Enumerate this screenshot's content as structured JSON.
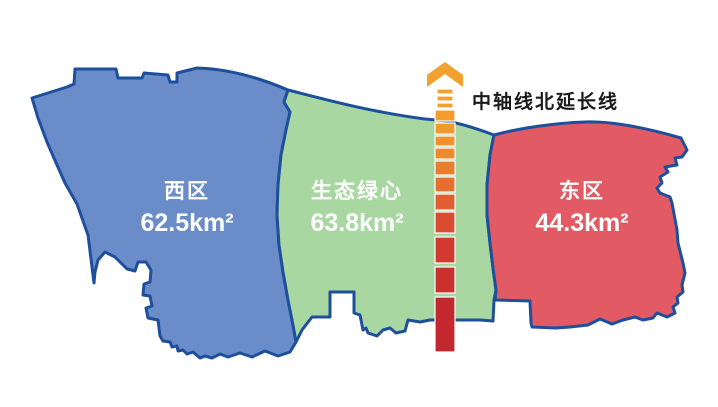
{
  "map": {
    "border_color": "#1D4F9C",
    "regions": [
      {
        "id": "west",
        "name": "西区",
        "area": "62.5km²",
        "fill": "#6A8CC8"
      },
      {
        "id": "green-heart",
        "name": "生态绿心",
        "area": "63.8km²",
        "fill": "#A8D7A2"
      },
      {
        "id": "east",
        "name": "东区",
        "area": "44.3km²",
        "fill": "#E25A63"
      }
    ]
  },
  "axis": {
    "label": "中轴线北延长线",
    "label_color": "#1A1A1A",
    "arrow_color": "#F2A12F",
    "dash_halo": "#FFFFFF",
    "dashes": [
      {
        "x": 437,
        "y": 89,
        "w": 16,
        "h": 5,
        "color": "#F5A12D"
      },
      {
        "x": 437,
        "y": 96,
        "w": 16,
        "h": 5,
        "color": "#F5A12D"
      },
      {
        "x": 437,
        "y": 103,
        "w": 16,
        "h": 5,
        "color": "#F4A02D"
      },
      {
        "x": 435,
        "y": 110,
        "w": 20,
        "h": 11,
        "color": "#F49C2D"
      },
      {
        "x": 435,
        "y": 123,
        "w": 20,
        "h": 11,
        "color": "#F2982E"
      },
      {
        "x": 435,
        "y": 136,
        "w": 20,
        "h": 10,
        "color": "#F0912E"
      },
      {
        "x": 435,
        "y": 148,
        "w": 20,
        "h": 11,
        "color": "#EE892E"
      },
      {
        "x": 435,
        "y": 161,
        "w": 20,
        "h": 14,
        "color": "#EA7E2F"
      },
      {
        "x": 435,
        "y": 177,
        "w": 20,
        "h": 15,
        "color": "#E66F2F"
      },
      {
        "x": 435,
        "y": 194,
        "w": 20,
        "h": 16,
        "color": "#E05F30"
      },
      {
        "x": 435,
        "y": 212,
        "w": 20,
        "h": 21,
        "color": "#DA4C30"
      },
      {
        "x": 435,
        "y": 237,
        "w": 20,
        "h": 26,
        "color": "#D23A2F"
      },
      {
        "x": 435,
        "y": 267,
        "w": 20,
        "h": 26,
        "color": "#CA302E"
      },
      {
        "x": 435,
        "y": 297,
        "w": 20,
        "h": 55,
        "color": "#C2282D"
      }
    ]
  }
}
